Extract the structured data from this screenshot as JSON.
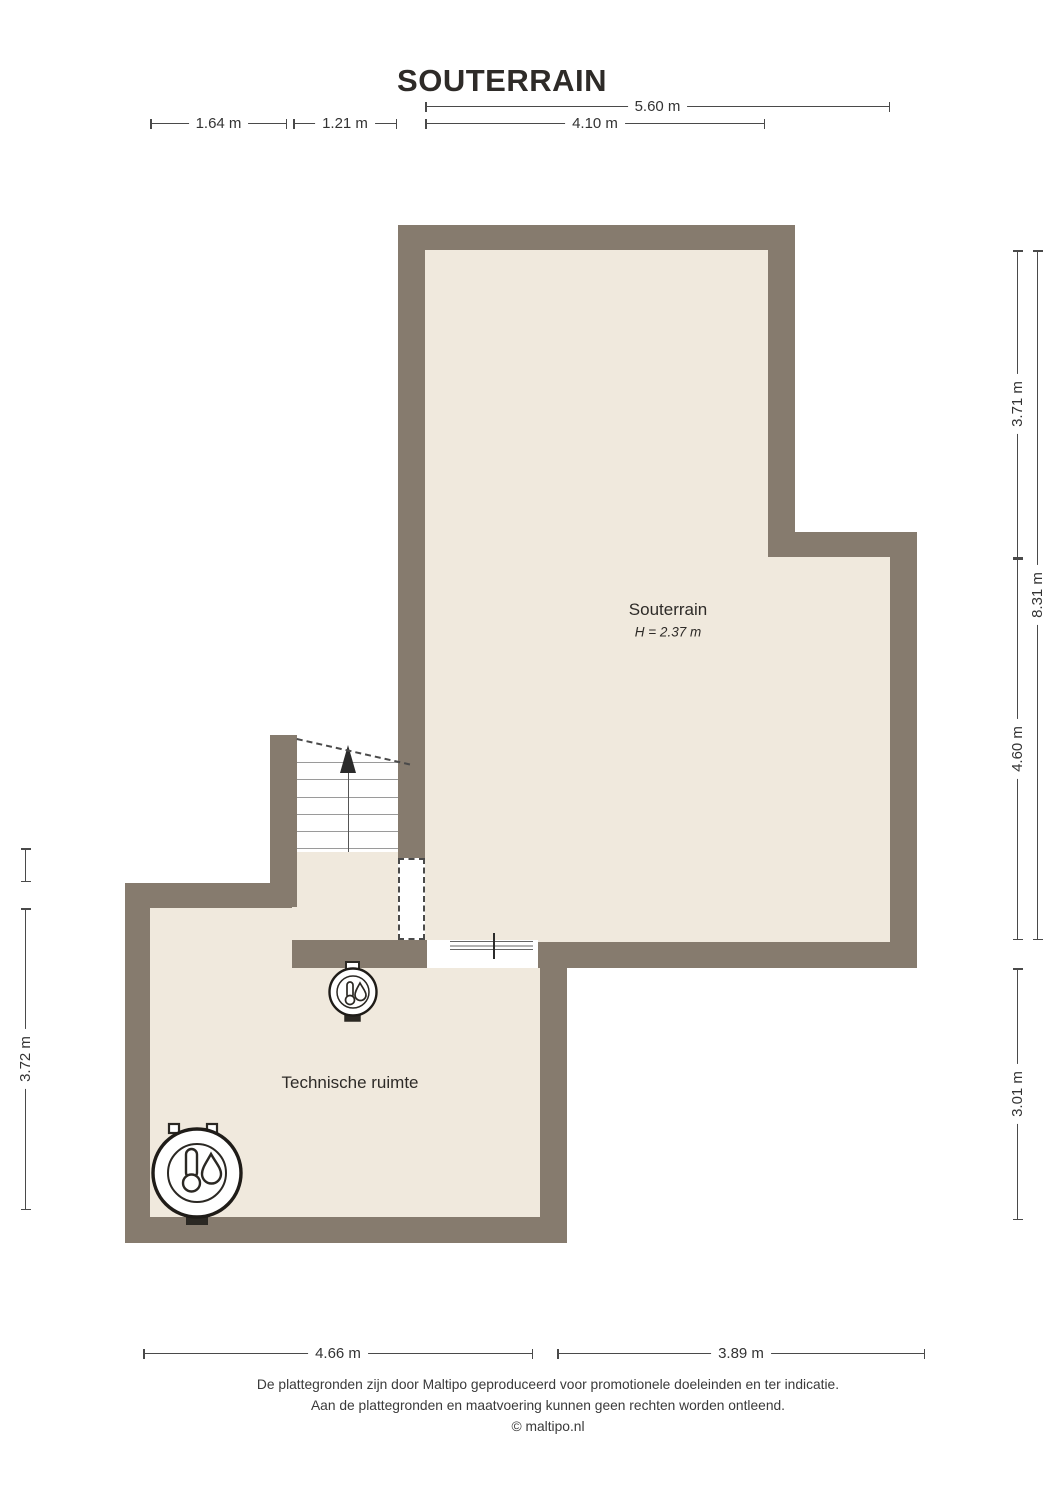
{
  "title": "SOUTERRAIN",
  "rooms": {
    "souterrain": {
      "name": "Souterrain",
      "height_label": "H = 2.37 m"
    },
    "technische_ruimte": {
      "name": "Technische ruimte"
    }
  },
  "dimensions": {
    "top": [
      {
        "label": "5.60 m"
      },
      {
        "label": "1.64 m"
      },
      {
        "label": "1.21 m"
      },
      {
        "label": "4.10 m"
      }
    ],
    "right": [
      {
        "label": "3.71 m"
      },
      {
        "label": "8.31 m"
      },
      {
        "label": "4.60 m"
      },
      {
        "label": "3.01 m"
      }
    ],
    "left": [
      {
        "label": "3.72 m"
      }
    ],
    "bottom": [
      {
        "label": "4.66 m"
      },
      {
        "label": "3.89 m"
      }
    ]
  },
  "icons": {
    "large_unit": {
      "name": "water-heater-boiler-icon"
    },
    "small_unit": {
      "name": "cv-boiler-icon"
    },
    "stairs": {
      "name": "staircase-up-arrow"
    }
  },
  "footer": {
    "line1": "De plattegronden zijn door Maltipo geproduceerd voor promotionele doeleinden en ter indicatie.",
    "line2": "Aan de plattegronden en maatvoering kunnen geen rechten worden ontleend.",
    "line3": "© maltipo.nl"
  },
  "colors": {
    "wall": "#867B6E",
    "floor": "#F0E9DD",
    "line": "#4A4A4A",
    "ink": "#2E2B28"
  }
}
